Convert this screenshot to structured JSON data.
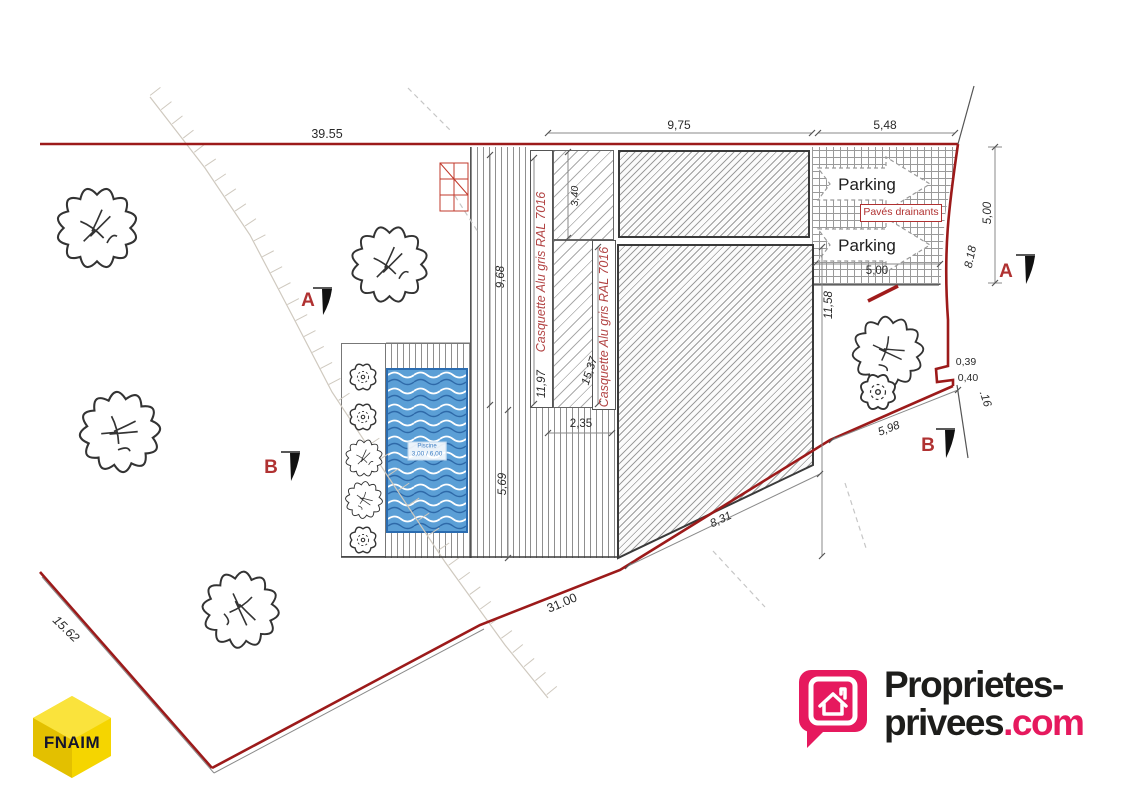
{
  "dims": {
    "d39_55": "39.55",
    "d9_75": "9,75",
    "d5_48": "5,48",
    "d5_00_right": "5,00",
    "d8_18": "8.18",
    "d3_40": "3,40",
    "d9_68": "9,68",
    "d11_97": "11,97",
    "d15_37": "15,37",
    "d2_35": "2,35",
    "d5_69": "5,69",
    "d11_58": "11,58",
    "d5_00_parking": "5,00",
    "d8_31": "8,31",
    "d31_00": "31.00",
    "d5_98": "5,98",
    "d15_62": "15.62",
    "d0_39": "0,39",
    "d0_40": "0,40",
    "d_16": ".16"
  },
  "labels": {
    "parking": "Parking",
    "paves_drainants": "Pavés drainants",
    "casquette": "Casquette Alu gris RAL 7016",
    "piscine": "Piscine",
    "piscine_size": "3,00 / 6,00"
  },
  "sections": {
    "a": "A",
    "b": "B"
  },
  "logos": {
    "fnaim": "FNAIM",
    "pp_top": "Proprietes-",
    "pp_bottom_black": "privees",
    "pp_bottom_accent": ".com"
  },
  "colors": {
    "boundary_red": "#9c1a1a",
    "annotation_red": "#b03232",
    "pool_blue": "#5b9fd6",
    "brand_pink": "#e6195e",
    "fnaim_yellow": "#f5d500"
  }
}
